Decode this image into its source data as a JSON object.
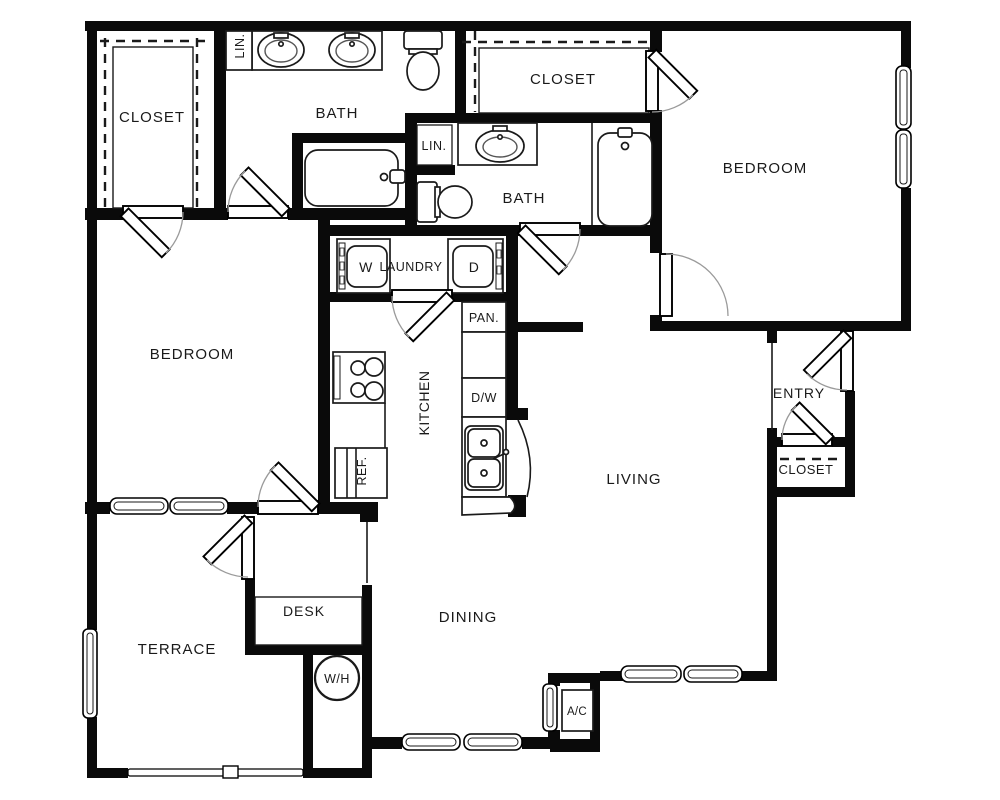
{
  "document_type": "apartment-floor-plan",
  "colors": {
    "wall": "#0a0a0a",
    "background": "#ffffff",
    "door_arc": "#9a9a9a",
    "text": "#1a1a1a"
  },
  "labels": {
    "closet_master": "CLOSET",
    "linen_master": "LIN.",
    "bath_master": "BATH",
    "closet_second": "CLOSET",
    "linen_hall": "LIN.",
    "bath_second": "BATH",
    "bedroom_right": "BEDROOM",
    "bedroom_left": "BEDROOM",
    "washer": "W",
    "laundry": "LAUNDRY",
    "dryer": "D",
    "pantry": "PAN.",
    "kitchen": "KITCHEN",
    "dishwasher": "D/W",
    "refrigerator": "REF.",
    "living": "LIVING",
    "entry": "ENTRY",
    "closet_entry": "CLOSET",
    "dining": "DINING",
    "desk": "DESK",
    "terrace": "TERRACE",
    "water_heater": "W/H",
    "air_conditioner": "A/C"
  }
}
